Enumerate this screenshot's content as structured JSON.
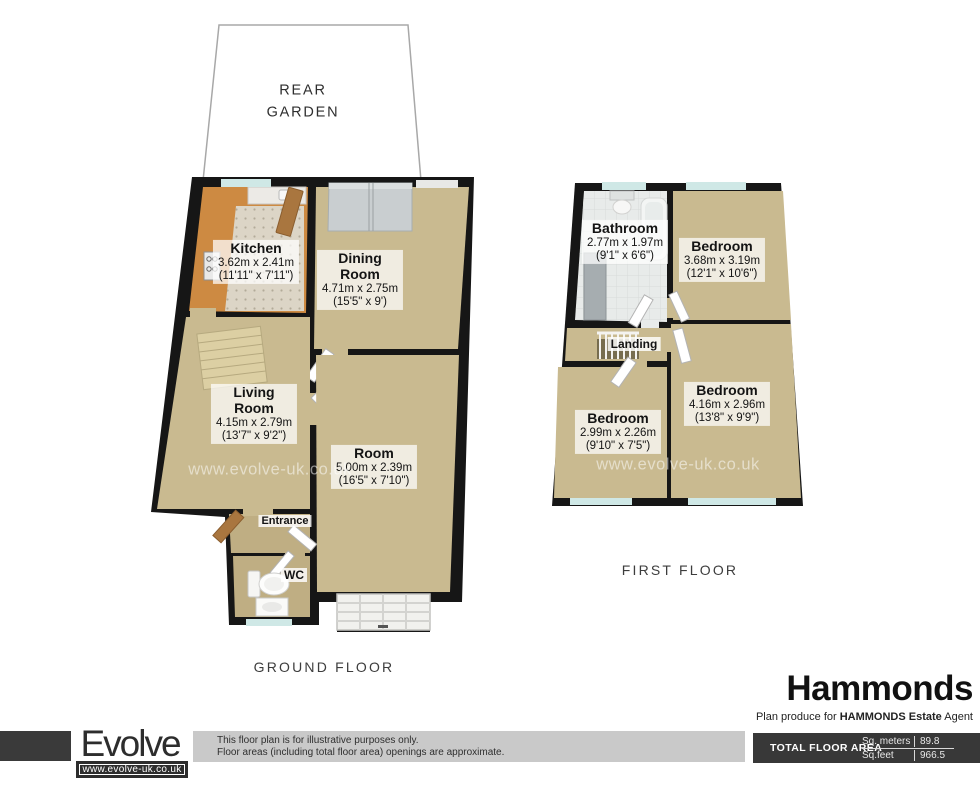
{
  "ground_floor": {
    "garden_label": "REAR GARDEN",
    "floor_label": "GROUND FLOOR",
    "watermark": "www.evolve-uk.co.uk",
    "rooms": [
      {
        "name": "Kitchen",
        "metric": "3.62m x 2.41m",
        "imperial": "(11'11\" x 7'11\")"
      },
      {
        "name": "Dining Room",
        "metric": "4.71m x 2.75m",
        "imperial": "(15'5\" x 9')"
      },
      {
        "name": "Living Room",
        "metric": "4.15m x 2.79m",
        "imperial": "(13'7\" x 9'2\")"
      },
      {
        "name": "Room",
        "metric": "5.00m x 2.39m",
        "imperial": "(16'5\" x 7'10\")"
      },
      {
        "name": "Entrance"
      },
      {
        "name": "WC"
      }
    ]
  },
  "first_floor": {
    "floor_label": "FIRST FLOOR",
    "watermark": "www.evolve-uk.co.uk",
    "rooms": [
      {
        "name": "Bathroom",
        "metric": "2.77m x 1.97m",
        "imperial": "(9'1\" x 6'6\")"
      },
      {
        "name": "Bedroom",
        "metric": "3.68m x 3.19m",
        "imperial": "(12'1\" x 10'6\")"
      },
      {
        "name": "Landing"
      },
      {
        "name": "Bedroom",
        "metric": "2.99m x 2.26m",
        "imperial": "(9'10\" x 7'5\")"
      },
      {
        "name": "Bedroom",
        "metric": "4.16m x 2.96m",
        "imperial": "(13'8\" x 9'9\")"
      }
    ]
  },
  "branding": {
    "agent_name": "Hammonds",
    "plan_credit_prefix": "Plan produce for ",
    "plan_credit_bold": "HAMMONDS Estate",
    "plan_credit_suffix": " Agent"
  },
  "footer": {
    "logo_text": "Evolve",
    "logo_url": "www.evolve-uk.co.uk",
    "disclaimer_line1": "This floor plan is for illustrative purposes only.",
    "disclaimer_line2": "Floor areas (including total floor area) openings are approximate.",
    "total_area_label": "TOTAL FLOOR AREA",
    "sq_meters_label": "Sq. meters",
    "sq_meters_value": "89.8",
    "sq_feet_label": "Sq.feet",
    "sq_feet_value": "966.5"
  },
  "colors": {
    "wall_black": "#161616",
    "floor_beige": "#c9ba90",
    "hall_beige": "#bfae83",
    "kitchen_orange": "#cd8a42",
    "bathroom_tile": "#e8ebea",
    "window_teal": "#cfe8e6",
    "wardrobe_gray": "#c9ced0",
    "footer_dark": "#383838",
    "disclaimer_gray": "#c9c9c9"
  }
}
